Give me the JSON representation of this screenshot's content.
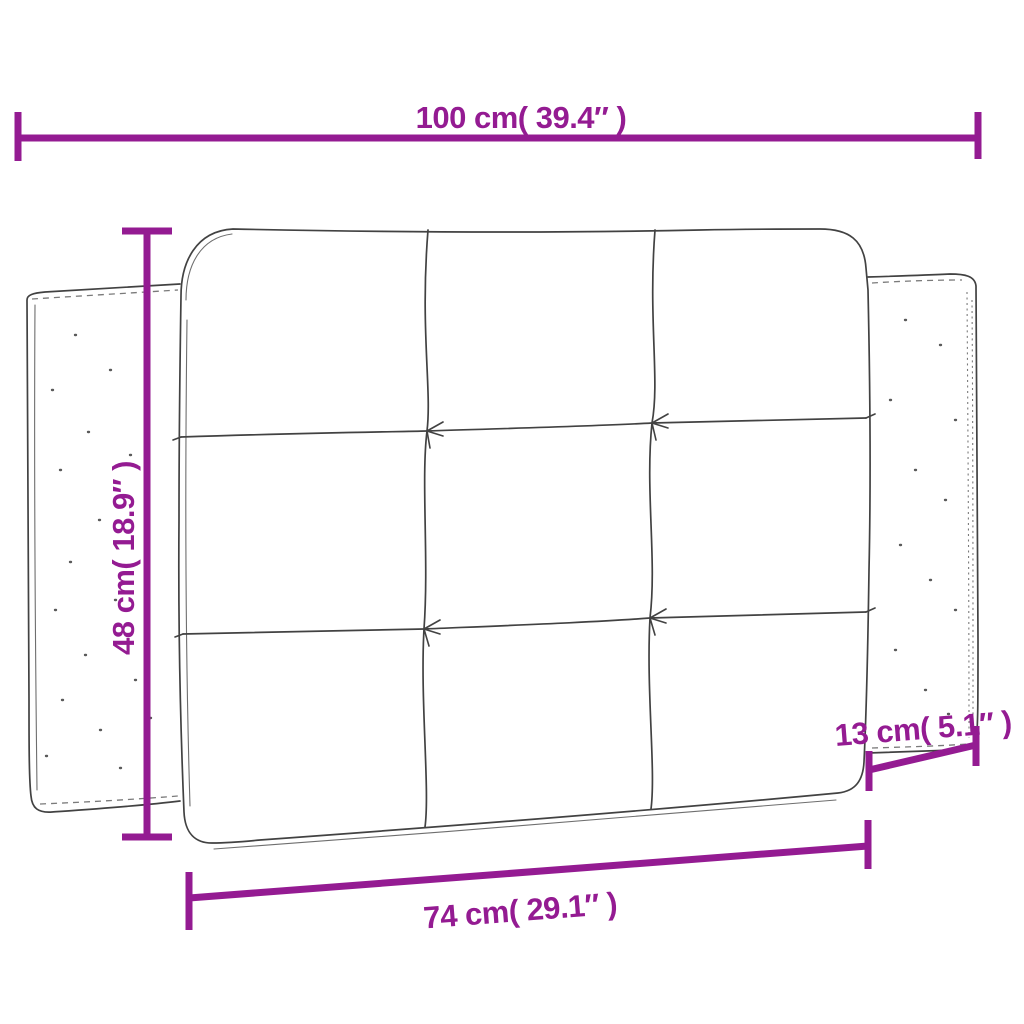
{
  "colors": {
    "dimension": "#941b92",
    "sketch": "#424242",
    "speckle": "#5a5a5a",
    "texture": "#7a7a7a",
    "background": "#ffffff"
  },
  "dimensions": {
    "overall_width": {
      "cm": 100,
      "inches": 39.4,
      "label": "100 cm( 39.4″ )"
    },
    "height": {
      "cm": 48,
      "inches": 18.9,
      "label": "48 cm( 18.9″ )"
    },
    "side_depth": {
      "cm": 13,
      "inches": 5.1,
      "label": "13 cm( 5.1″ )"
    },
    "inner_width": {
      "cm": 74,
      "inches": 29.1,
      "label": "74 cm( 29.1″ )"
    }
  }
}
